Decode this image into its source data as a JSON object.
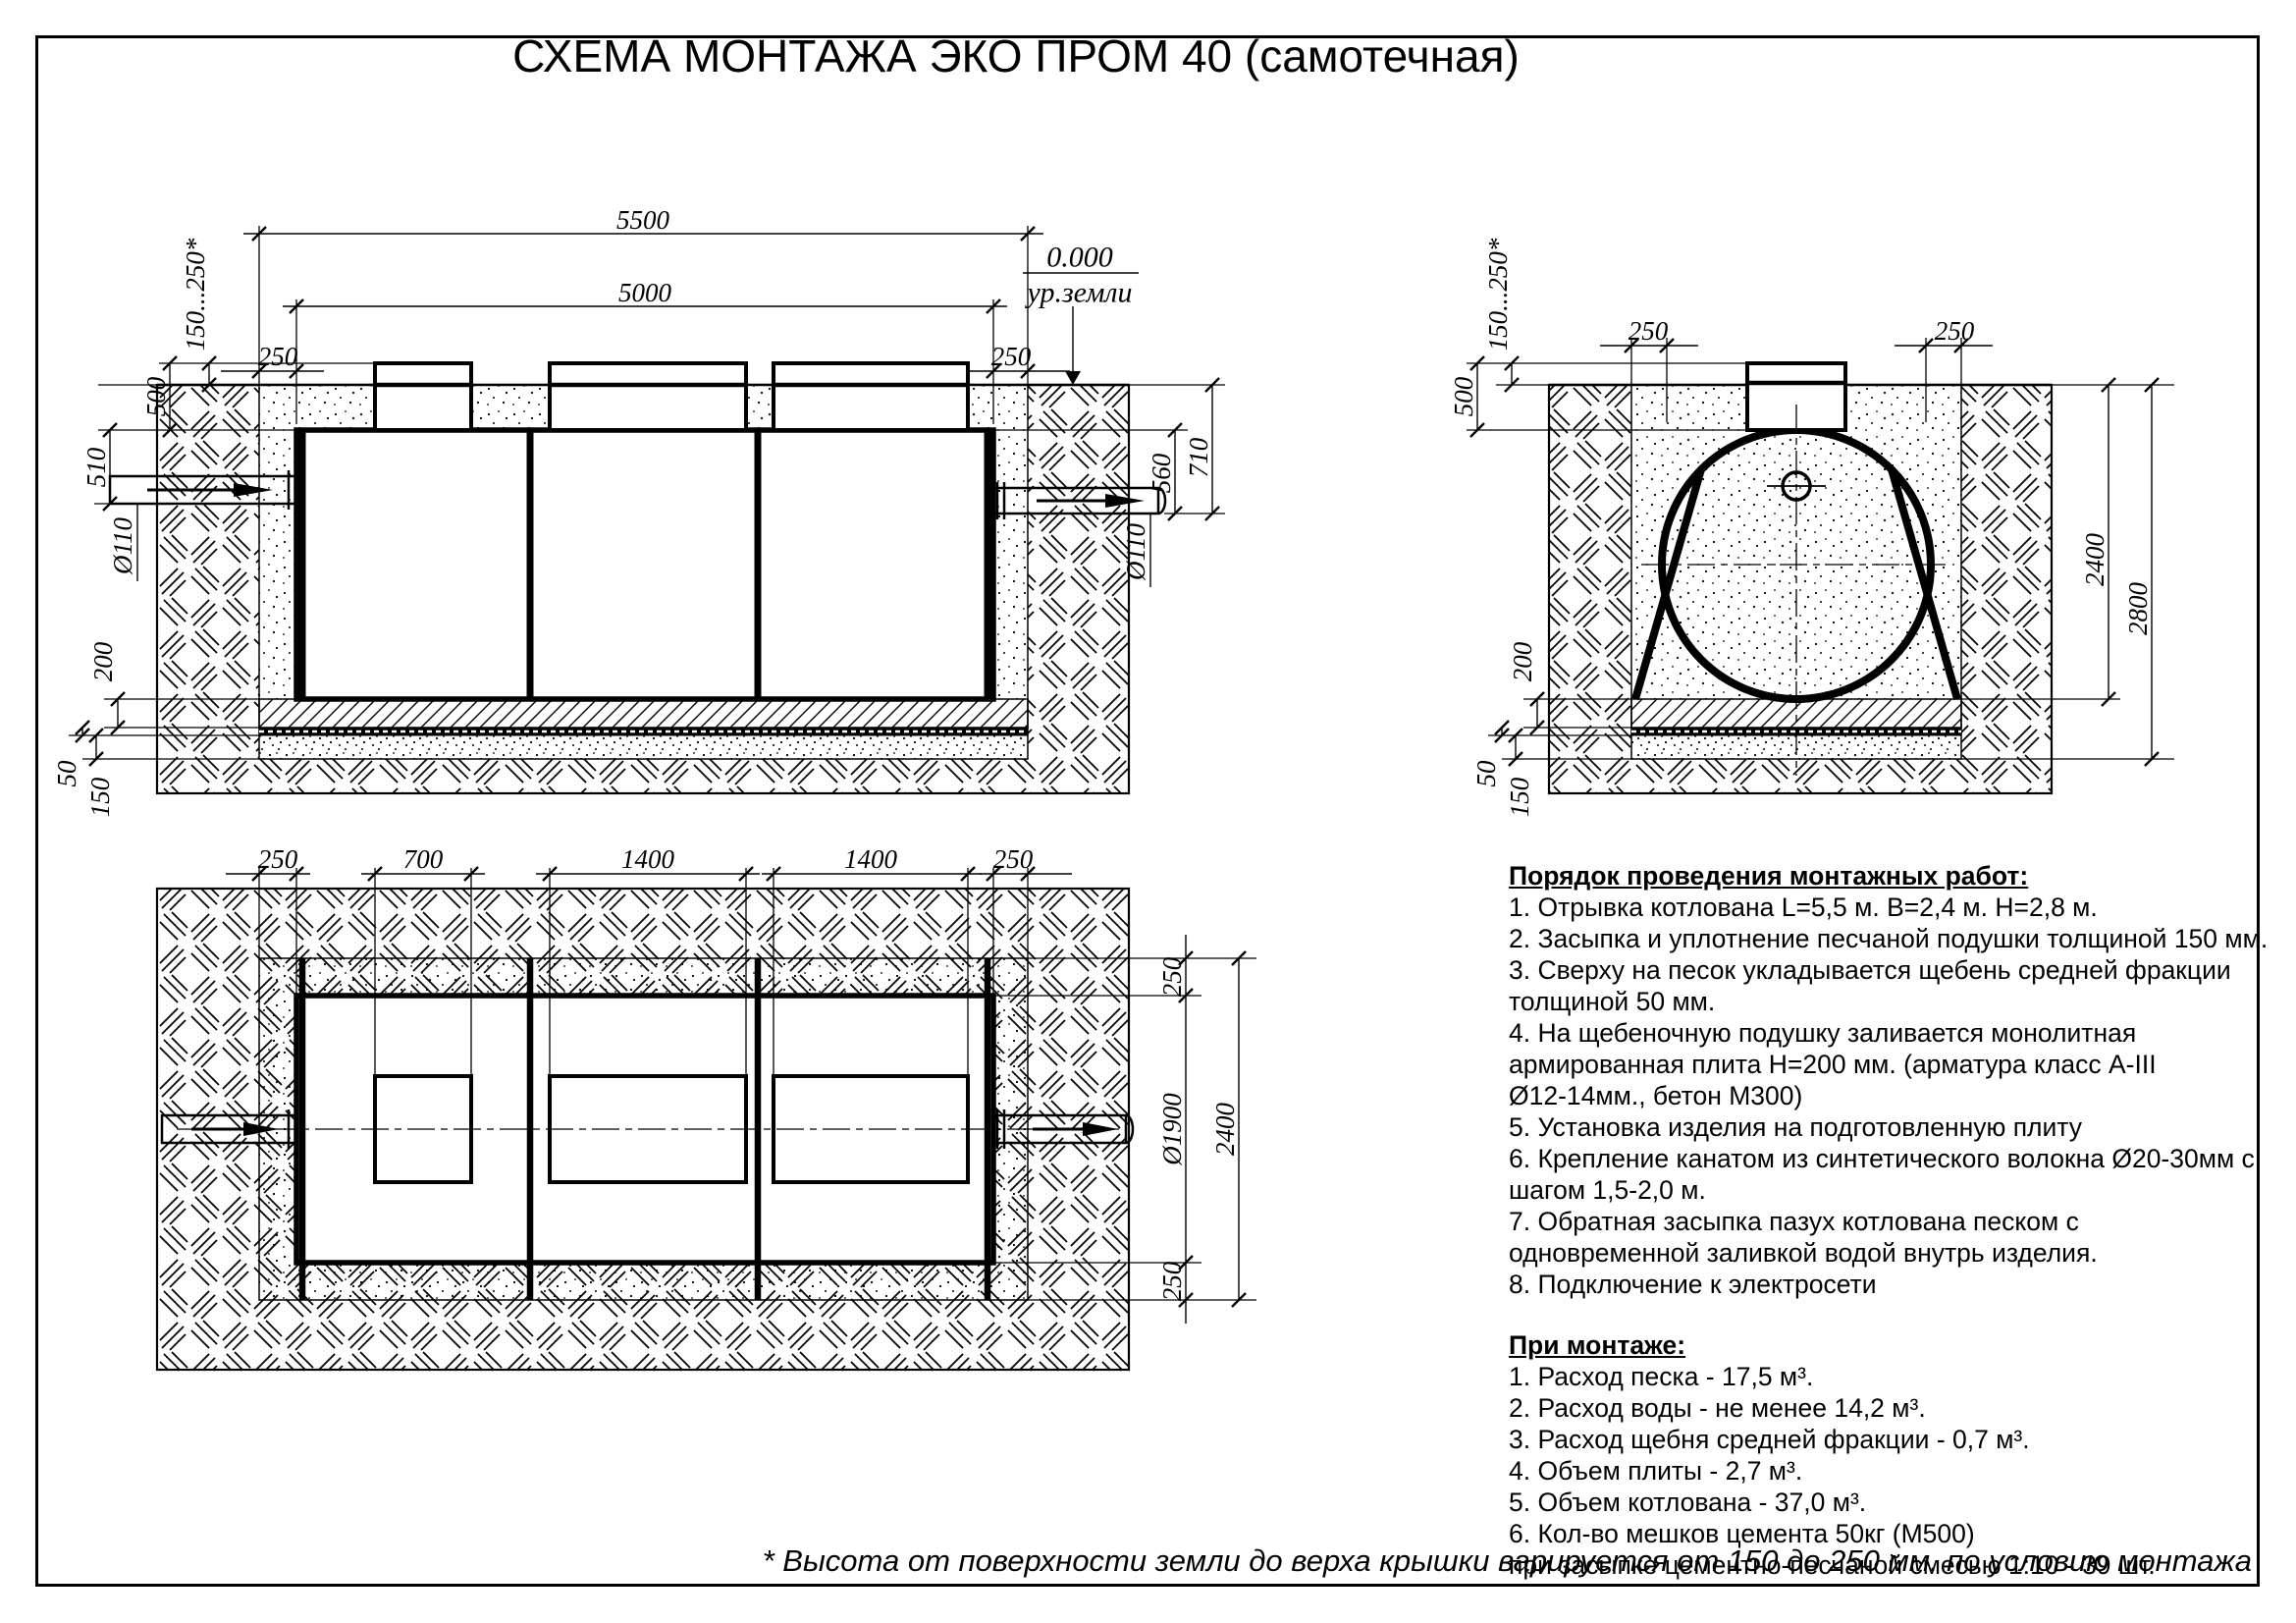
{
  "title": "СХЕМА МОНТАЖА ЭКО ПРОМ 40 (самотечная)",
  "footnote": "* Высота от поверхности земли до верха крышки варируется от 150 до 250 мм. по условию монтажа",
  "work_order": {
    "heading": "Порядок проведения монтажных работ:",
    "items": [
      "1. Отрывка котлована L=5,5 м. B=2,4 м. H=2,8 м.",
      "2. Засыпка и уплотнение песчаной подушки толщиной 150 мм.",
      "3. Сверху на песок укладывается щебень средней фракции\nтолщиной 50 мм.",
      "4. На щебеночную подушку заливается монолитная\nармированная плита H=200 мм. (арматура класс А-III\nØ12-14мм., бетон М300)",
      "5. Установка изделия на подготовленную плиту",
      "6. Крепление канатом из синтетического волокна Ø20-30мм с\nшагом 1,5-2,0 м.",
      "7. Обратная засыпка пазух котлована песком с\nодновременной заливкой водой внутрь изделия.",
      "8. Подключение к электросети"
    ]
  },
  "installation": {
    "heading": "При монтаже:",
    "items": [
      "1. Расход песка - 17,5 м³.",
      "2. Расход воды - не менее 14,2 м³.",
      "3. Расход щебня средней фракции - 0,7 м³.",
      "4. Объем плиты - 2,7 м³.",
      "5. Объем котлована - 37,0 м³.",
      "6. Кол-во мешков цемента 50кг (М500)\nпри засыпке цементно-песчаной смесью 1:10 - 39 шт."
    ]
  },
  "side_view": {
    "dims": {
      "pit_length": "5500",
      "tank_length": "5000",
      "gap_left": "250",
      "gap_right": "250",
      "neck_height": "500",
      "cover_height": "150...250*",
      "inlet_drop": "510",
      "inlet_dia": "Ø110",
      "slab": "200",
      "gravel": "50",
      "sand": "150",
      "outlet_top": "560",
      "outlet_drop": "710",
      "outlet_dia": "Ø110",
      "level": "0.000",
      "level_label": "ур.земли"
    }
  },
  "end_view": {
    "dims": {
      "neck_height": "500",
      "cover_height": "150...250*",
      "gap_left": "250",
      "gap_right": "250",
      "depth_to_slab": "2400",
      "pit_depth": "2800",
      "slab": "200",
      "gravel": "50",
      "sand": "150"
    }
  },
  "plan_view": {
    "dims": {
      "gap_left": "250",
      "hatch_small": "700",
      "hatch_mid": "1400",
      "hatch_right": "1400",
      "gap_right": "250",
      "gap_top": "250",
      "tank_dia": "Ø1900",
      "pit_width": "2400",
      "gap_bottom": "250"
    }
  }
}
